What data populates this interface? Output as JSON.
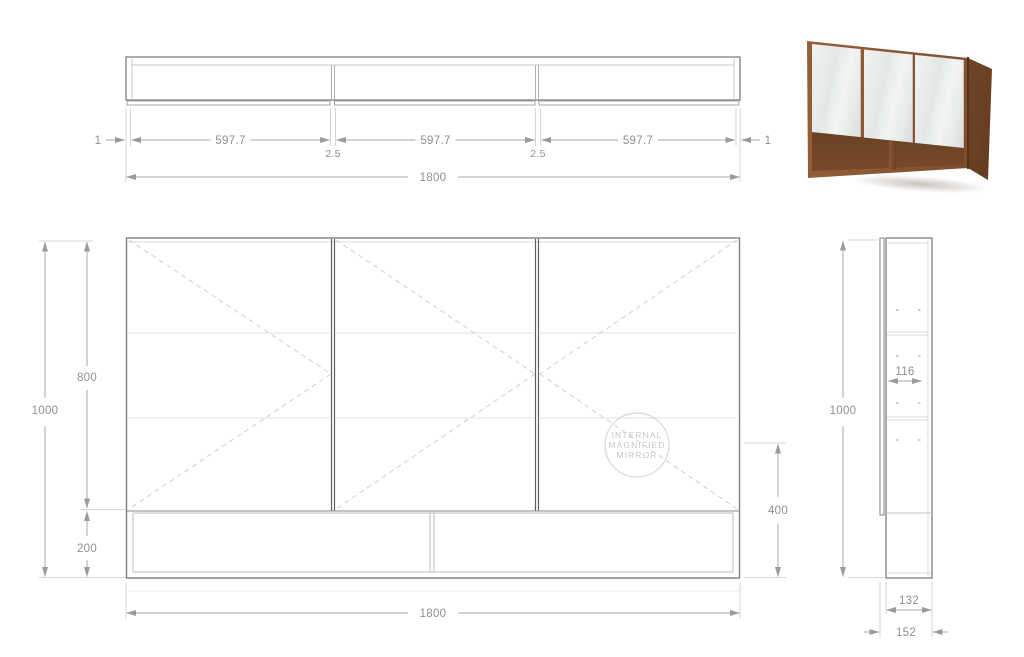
{
  "drawing": {
    "line_color": "#7f7f7f",
    "light_line_color": "#d6d6d6",
    "dim_line_color": "#a8a8a8",
    "dim_text_color": "#8f8f8f",
    "dash_color": "#cfcfcf"
  },
  "dimensions": {
    "top_view": {
      "edge_gap": "1",
      "door_width": "597.7",
      "door_gap": "2.5",
      "total_width": "1800"
    },
    "front_view": {
      "total_height": "1000",
      "door_height": "800",
      "shelf_height": "200",
      "total_width": "1800",
      "niche_height": "400"
    },
    "side_view": {
      "total_height": "1000",
      "internal_depth": "116",
      "cabinet_depth": "132",
      "total_depth": "152"
    }
  },
  "stamp": {
    "line1": "INTERNAL",
    "line2": "MAGNIFIED",
    "line3": "MIRROR"
  },
  "product_photo": {
    "description": "three-door mirrored wall cabinet in timber with open bottom shelf",
    "wood_color": "#8a5733",
    "wood_dark_color": "#5e381e",
    "mirror_color": "#e9edec"
  }
}
